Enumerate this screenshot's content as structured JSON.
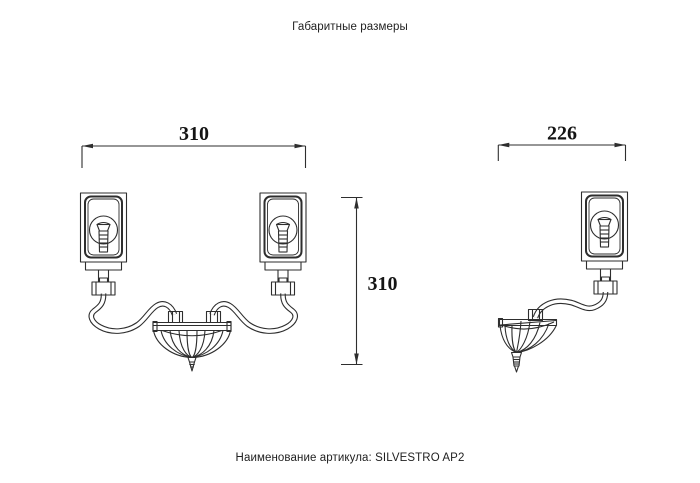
{
  "page": {
    "title": "Габаритные размеры"
  },
  "footer": {
    "label": "Наименование артикула:",
    "article": "SILVESTRO AP2"
  },
  "dimensions": {
    "front_width": "310",
    "front_height": "310",
    "side_width": "226"
  },
  "colors": {
    "line": "#2e2e2e",
    "shade_highlight": "#f5e400",
    "background": "#ffffff"
  }
}
